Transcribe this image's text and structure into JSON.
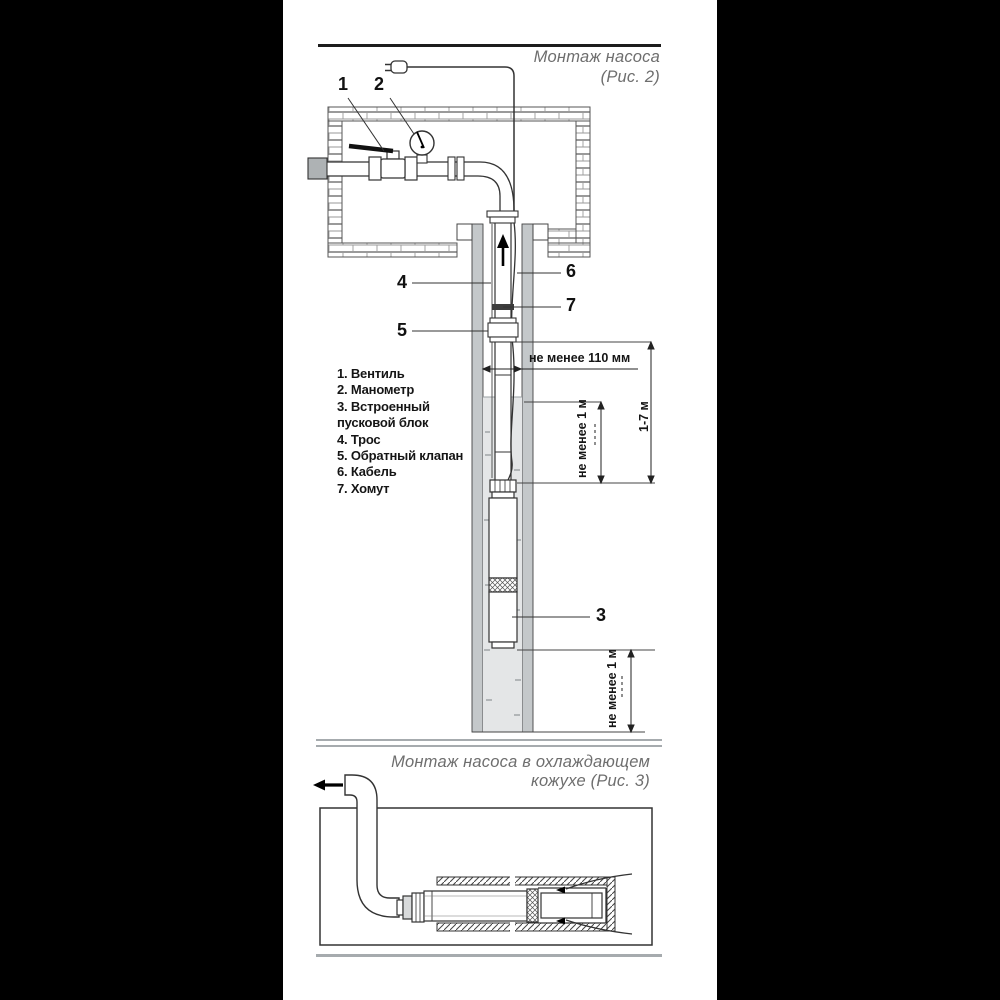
{
  "fig2": {
    "title": [
      "Монтаж насоса",
      "(Рис. 2)"
    ],
    "callouts": {
      "c1": "1",
      "c2": "2",
      "c3": "3",
      "c4": "4",
      "c5": "5",
      "c6": "6",
      "c7": "7"
    },
    "legend": [
      "1. Вентиль",
      "2. Манометр",
      "3. Встроенный",
      "пусковой блок",
      "4. Трос",
      "5. Обратный клапан",
      "6. Кабель",
      "7. Хомут"
    ],
    "dimensions": {
      "min_width": "не менее 110 мм",
      "min_submersion": "не менее 1 м",
      "cable_length_range": "1-7 м",
      "min_bottom_clearance": "не менее 1 м"
    }
  },
  "fig3": {
    "title": [
      "Монтаж насоса в охлаждающем",
      "кожухе (Рис. 3)"
    ]
  },
  "colors": {
    "line": "#333333",
    "casing": "#c4c8ca",
    "water": "#e4e6e7",
    "title_gray": "#6e6e6e"
  }
}
